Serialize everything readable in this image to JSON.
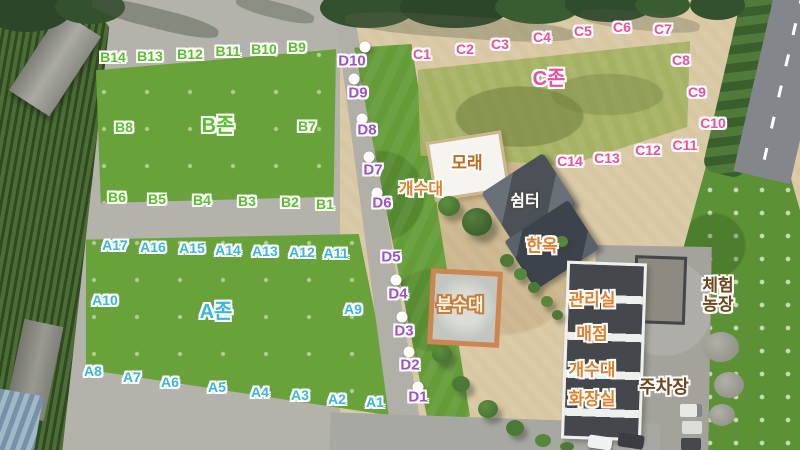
{
  "map": {
    "description_labels_language": "Korean",
    "colors": {
      "zone_a": "#38b7dd",
      "zone_b": "#5abf2c",
      "zone_c": "#ee4f9d",
      "zone_d": "#9b50cd",
      "orange": "#e0802c",
      "brown": "#c06a1f",
      "dark_brown": "#6f451b",
      "white": "#ffffff",
      "cream": "#fdf4e4",
      "outline_white": "#ffffff",
      "outline_dark": "#4b4b4b",
      "outline_orange": "#c57c3c"
    },
    "zone_labels": [
      {
        "name": "zone-label-b",
        "text": "B존",
        "x": 218,
        "y": 126,
        "color": "zone_b",
        "size": 20
      },
      {
        "name": "zone-label-a",
        "text": "A존",
        "x": 216,
        "y": 312,
        "color": "zone_a",
        "size": 20
      },
      {
        "name": "zone-label-c",
        "text": "C존",
        "x": 549,
        "y": 79,
        "color": "zone_c",
        "size": 20
      }
    ],
    "site_labels": [
      {
        "name": "site-label-b14",
        "text": "B14",
        "x": 113,
        "y": 58,
        "color": "zone_b",
        "size": 14
      },
      {
        "name": "site-label-b13",
        "text": "B13",
        "x": 150,
        "y": 57,
        "color": "zone_b",
        "size": 14
      },
      {
        "name": "site-label-b12",
        "text": "B12",
        "x": 190,
        "y": 55,
        "color": "zone_b",
        "size": 14
      },
      {
        "name": "site-label-b11",
        "text": "B11",
        "x": 228,
        "y": 52,
        "color": "zone_b",
        "size": 14
      },
      {
        "name": "site-label-b10",
        "text": "B10",
        "x": 264,
        "y": 50,
        "color": "zone_b",
        "size": 14
      },
      {
        "name": "site-label-b9",
        "text": "B9",
        "x": 297,
        "y": 48,
        "color": "zone_b",
        "size": 14
      },
      {
        "name": "site-label-b8",
        "text": "B8",
        "x": 124,
        "y": 128,
        "color": "zone_b",
        "size": 14
      },
      {
        "name": "site-label-b7",
        "text": "B7",
        "x": 307,
        "y": 127,
        "color": "zone_b",
        "size": 14
      },
      {
        "name": "site-label-b6",
        "text": "B6",
        "x": 117,
        "y": 198,
        "color": "zone_b",
        "size": 14
      },
      {
        "name": "site-label-b5",
        "text": "B5",
        "x": 157,
        "y": 200,
        "color": "zone_b",
        "size": 14
      },
      {
        "name": "site-label-b4",
        "text": "B4",
        "x": 202,
        "y": 201,
        "color": "zone_b",
        "size": 14
      },
      {
        "name": "site-label-b3",
        "text": "B3",
        "x": 247,
        "y": 202,
        "color": "zone_b",
        "size": 14
      },
      {
        "name": "site-label-b2",
        "text": "B2",
        "x": 290,
        "y": 203,
        "color": "zone_b",
        "size": 14
      },
      {
        "name": "site-label-b1",
        "text": "B1",
        "x": 325,
        "y": 205,
        "color": "zone_b",
        "size": 14
      },
      {
        "name": "site-label-a17",
        "text": "A17",
        "x": 115,
        "y": 246,
        "color": "zone_a",
        "size": 14
      },
      {
        "name": "site-label-a16",
        "text": "A16",
        "x": 153,
        "y": 248,
        "color": "zone_a",
        "size": 14
      },
      {
        "name": "site-label-a15",
        "text": "A15",
        "x": 192,
        "y": 249,
        "color": "zone_a",
        "size": 14
      },
      {
        "name": "site-label-a14",
        "text": "A14",
        "x": 228,
        "y": 251,
        "color": "zone_a",
        "size": 14
      },
      {
        "name": "site-label-a13",
        "text": "A13",
        "x": 265,
        "y": 252,
        "color": "zone_a",
        "size": 14
      },
      {
        "name": "site-label-a12",
        "text": "A12",
        "x": 302,
        "y": 253,
        "color": "zone_a",
        "size": 14
      },
      {
        "name": "site-label-a11",
        "text": "A11",
        "x": 336,
        "y": 254,
        "color": "zone_a",
        "size": 14
      },
      {
        "name": "site-label-a10",
        "text": "A10",
        "x": 105,
        "y": 301,
        "color": "zone_a",
        "size": 14
      },
      {
        "name": "site-label-a9",
        "text": "A9",
        "x": 353,
        "y": 310,
        "color": "zone_a",
        "size": 14
      },
      {
        "name": "site-label-a8",
        "text": "A8",
        "x": 93,
        "y": 372,
        "color": "zone_a",
        "size": 14
      },
      {
        "name": "site-label-a7",
        "text": "A7",
        "x": 132,
        "y": 378,
        "color": "zone_a",
        "size": 14
      },
      {
        "name": "site-label-a6",
        "text": "A6",
        "x": 170,
        "y": 383,
        "color": "zone_a",
        "size": 14
      },
      {
        "name": "site-label-a5",
        "text": "A5",
        "x": 217,
        "y": 388,
        "color": "zone_a",
        "size": 14
      },
      {
        "name": "site-label-a4",
        "text": "A4",
        "x": 260,
        "y": 393,
        "color": "zone_a",
        "size": 14
      },
      {
        "name": "site-label-a3",
        "text": "A3",
        "x": 300,
        "y": 396,
        "color": "zone_a",
        "size": 14
      },
      {
        "name": "site-label-a2",
        "text": "A2",
        "x": 337,
        "y": 400,
        "color": "zone_a",
        "size": 14
      },
      {
        "name": "site-label-a1",
        "text": "A1",
        "x": 375,
        "y": 403,
        "color": "zone_a",
        "size": 14
      },
      {
        "name": "site-label-c1",
        "text": "C1",
        "x": 422,
        "y": 55,
        "color": "zone_c",
        "size": 14
      },
      {
        "name": "site-label-c2",
        "text": "C2",
        "x": 465,
        "y": 50,
        "color": "zone_c",
        "size": 14
      },
      {
        "name": "site-label-c3",
        "text": "C3",
        "x": 500,
        "y": 45,
        "color": "zone_c",
        "size": 14
      },
      {
        "name": "site-label-c4",
        "text": "C4",
        "x": 542,
        "y": 38,
        "color": "zone_c",
        "size": 14
      },
      {
        "name": "site-label-c5",
        "text": "C5",
        "x": 583,
        "y": 32,
        "color": "zone_c",
        "size": 14
      },
      {
        "name": "site-label-c6",
        "text": "C6",
        "x": 622,
        "y": 28,
        "color": "zone_c",
        "size": 14
      },
      {
        "name": "site-label-c7",
        "text": "C7",
        "x": 663,
        "y": 30,
        "color": "zone_c",
        "size": 14
      },
      {
        "name": "site-label-c8",
        "text": "C8",
        "x": 681,
        "y": 61,
        "color": "zone_c",
        "size": 14
      },
      {
        "name": "site-label-c9",
        "text": "C9",
        "x": 697,
        "y": 93,
        "color": "zone_c",
        "size": 14
      },
      {
        "name": "site-label-c10",
        "text": "C10",
        "x": 713,
        "y": 124,
        "color": "zone_c",
        "size": 14
      },
      {
        "name": "site-label-c11",
        "text": "C11",
        "x": 685,
        "y": 146,
        "color": "zone_c",
        "size": 14
      },
      {
        "name": "site-label-c12",
        "text": "C12",
        "x": 648,
        "y": 151,
        "color": "zone_c",
        "size": 14
      },
      {
        "name": "site-label-c13",
        "text": "C13",
        "x": 607,
        "y": 159,
        "color": "zone_c",
        "size": 14
      },
      {
        "name": "site-label-c14",
        "text": "C14",
        "x": 570,
        "y": 162,
        "color": "zone_c",
        "size": 14
      },
      {
        "name": "site-label-d10",
        "text": "D10",
        "x": 352,
        "y": 62,
        "color": "zone_d",
        "size": 15
      },
      {
        "name": "site-label-d9",
        "text": "D9",
        "x": 358,
        "y": 94,
        "color": "zone_d",
        "size": 15
      },
      {
        "name": "site-label-d8",
        "text": "D8",
        "x": 367,
        "y": 131,
        "color": "zone_d",
        "size": 15
      },
      {
        "name": "site-label-d7",
        "text": "D7",
        "x": 373,
        "y": 171,
        "color": "zone_d",
        "size": 15
      },
      {
        "name": "site-label-d6",
        "text": "D6",
        "x": 382,
        "y": 204,
        "color": "zone_d",
        "size": 15
      },
      {
        "name": "site-label-d5",
        "text": "D5",
        "x": 391,
        "y": 258,
        "color": "zone_d",
        "size": 15
      },
      {
        "name": "site-label-d4",
        "text": "D4",
        "x": 398,
        "y": 295,
        "color": "zone_d",
        "size": 15
      },
      {
        "name": "site-label-d3",
        "text": "D3",
        "x": 404,
        "y": 332,
        "color": "zone_d",
        "size": 15
      },
      {
        "name": "site-label-d2",
        "text": "D2",
        "x": 410,
        "y": 366,
        "color": "zone_d",
        "size": 15
      },
      {
        "name": "site-label-d1",
        "text": "D1",
        "x": 418,
        "y": 398,
        "color": "zone_d",
        "size": 15
      }
    ],
    "facility_labels": [
      {
        "name": "facility-label-sand-pit",
        "text": "모래",
        "x": 467,
        "y": 163,
        "color": "brown",
        "outline": "#ffffff",
        "size": 17
      },
      {
        "name": "facility-label-sink-north",
        "text": "개수대",
        "x": 421,
        "y": 190,
        "color": "orange",
        "outline": "#ffffff",
        "size": 16
      },
      {
        "name": "facility-label-shelter",
        "text": "쉼터",
        "x": 525,
        "y": 202,
        "color": "white",
        "outline": "#4b4b4b",
        "size": 16
      },
      {
        "name": "facility-label-hanok",
        "text": "한옥",
        "x": 542,
        "y": 246,
        "color": "orange",
        "outline": "#ffffff",
        "size": 17
      },
      {
        "name": "facility-label-fountain",
        "text": "분수대",
        "x": 460,
        "y": 305,
        "color": "cream",
        "outline": "#c57c3c",
        "size": 17
      },
      {
        "name": "facility-label-office",
        "text": "관리실",
        "x": 592,
        "y": 300,
        "color": "orange",
        "outline": "#ffffff",
        "size": 17
      },
      {
        "name": "facility-label-store",
        "text": "매점",
        "x": 592,
        "y": 334,
        "color": "orange",
        "outline": "#ffffff",
        "size": 17
      },
      {
        "name": "facility-label-sink-south",
        "text": "개수대",
        "x": 592,
        "y": 370,
        "color": "orange",
        "outline": "#ffffff",
        "size": 17
      },
      {
        "name": "facility-label-restroom",
        "text": "화장실",
        "x": 592,
        "y": 399,
        "color": "orange",
        "outline": "#ffffff",
        "size": 17
      },
      {
        "name": "facility-label-parking",
        "text": "주차장",
        "x": 664,
        "y": 387,
        "color": "dark_brown",
        "outline": "#ffffff",
        "size": 18
      },
      {
        "name": "facility-label-experience-farm",
        "text": "체험\n농장",
        "x": 718,
        "y": 295,
        "color": "dark_brown",
        "outline": "#ffffff",
        "size": 17
      }
    ],
    "site_markers": [
      {
        "x": 365,
        "y": 47
      },
      {
        "x": 354,
        "y": 79
      },
      {
        "x": 362,
        "y": 119
      },
      {
        "x": 369,
        "y": 157
      },
      {
        "x": 377,
        "y": 193
      },
      {
        "x": 396,
        "y": 280
      },
      {
        "x": 402,
        "y": 317
      },
      {
        "x": 409,
        "y": 352
      },
      {
        "x": 418,
        "y": 387
      }
    ]
  }
}
